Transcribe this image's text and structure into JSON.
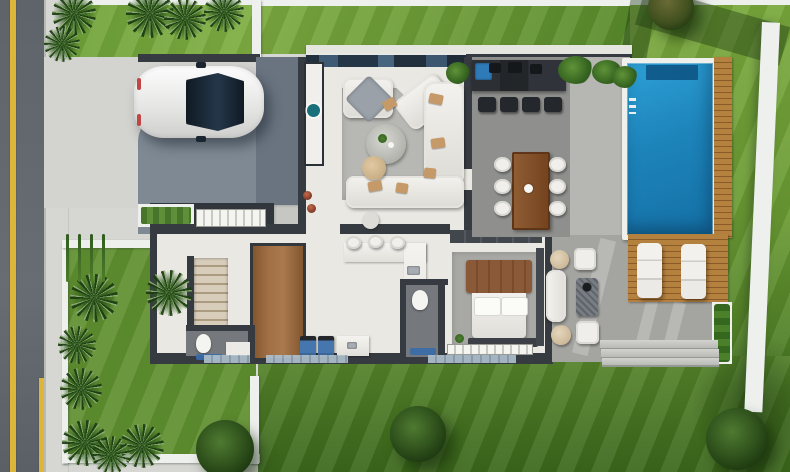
{
  "meta": {
    "title": "3D villa floor plan - top view rendering",
    "type": "architectural-rendering",
    "no_visible_text": true
  },
  "palette": {
    "road": "#5e646a",
    "yellow": "#ddb637",
    "sidewalk": "#d6d7d3",
    "whiteWall": "#eef0ee",
    "garden": "#609030",
    "drive": "#d3d3cf",
    "slab": "#6a7480",
    "slabLight": "#7e8993",
    "wall": "#363b41",
    "cream": "#eae8e2",
    "patio": "#a4a5a1",
    "patioLight": "#b6b7b3",
    "coping": "#eff0ec",
    "poolStep": "#0d5585",
    "deck": "#b5813f",
    "deckLine": "#8a5a28",
    "rug": "#b7b7b3",
    "rugBed": "#a8a8a5",
    "tan": "#c59a68",
    "teal": "#19707a",
    "blue": "#3a6ba8",
    "sinkBlue": "#2f7ab8",
    "bath": "#75787c",
    "treeLight": "#4e7a31",
    "poolWater": "#1d84ba",
    "carWhite": "#f2f2f1",
    "carGlass": "#17222e"
  },
  "scene": {
    "areas": [
      "street",
      "sidewalk",
      "driveway",
      "front-garden",
      "front-lawn",
      "back-lawn",
      "side-lawn",
      "covered-patio",
      "pool-terrace"
    ],
    "rooms": [
      "living-room",
      "kitchen",
      "hallway",
      "stairs",
      "bathroom",
      "powder-room",
      "bedroom",
      "laundry",
      "entry-porch"
    ],
    "outdoor_features": [
      "swimming-pool",
      "wood-deck",
      "sun-loungers",
      "outdoor-dining-table",
      "outdoor-bar",
      "lounge-set-with-fire-table",
      "garden-steps",
      "hedge-planter"
    ],
    "street_markings": [
      "yellow-center-line",
      "yellow-edge-line"
    ],
    "vehicle": "white-hatchback-car-on-driveway"
  },
  "sprites": [
    {
      "cls": "palm",
      "name": "palm-tree",
      "x": 52,
      "y": -8,
      "w": 44,
      "h": 44
    },
    {
      "cls": "palm",
      "name": "palm-tree",
      "x": 44,
      "y": 26,
      "w": 36,
      "h": 36
    },
    {
      "cls": "palm",
      "name": "palm-tree",
      "x": 126,
      "y": -10,
      "w": 48,
      "h": 48
    },
    {
      "cls": "palm",
      "name": "palm-tree",
      "x": 164,
      "y": -2,
      "w": 42,
      "h": 42
    },
    {
      "cls": "palm",
      "name": "palm-tree",
      "x": 204,
      "y": -8,
      "w": 40,
      "h": 40
    },
    {
      "cls": "palm",
      "name": "palm-tree",
      "x": 70,
      "y": 274,
      "w": 48,
      "h": 48
    },
    {
      "cls": "palm",
      "name": "palm-tree",
      "x": 58,
      "y": 326,
      "w": 38,
      "h": 38
    },
    {
      "cls": "palm",
      "name": "palm-tree",
      "x": 60,
      "y": 368,
      "w": 42,
      "h": 42
    },
    {
      "cls": "palm",
      "name": "palm-tree",
      "x": 62,
      "y": 420,
      "w": 46,
      "h": 46
    },
    {
      "cls": "palm",
      "name": "palm-tree",
      "x": 120,
      "y": 424,
      "w": 44,
      "h": 44
    },
    {
      "cls": "palm",
      "name": "palm-tree",
      "x": 146,
      "y": 270,
      "w": 46,
      "h": 46
    },
    {
      "cls": "palm",
      "name": "palm-tree",
      "x": 92,
      "y": 436,
      "w": 38,
      "h": 38
    },
    {
      "cls": "grass-tuft",
      "name": "tall-grass",
      "x": 66,
      "y": 234,
      "w": 3,
      "h": 48
    },
    {
      "cls": "grass-tuft",
      "name": "tall-grass",
      "x": 78,
      "y": 234,
      "w": 3,
      "h": 48
    },
    {
      "cls": "grass-tuft",
      "name": "tall-grass",
      "x": 90,
      "y": 234,
      "w": 3,
      "h": 48
    },
    {
      "cls": "grass-tuft",
      "name": "tall-grass",
      "x": 102,
      "y": 234,
      "w": 3,
      "h": 48
    },
    {
      "cls": "plant-blob",
      "name": "plant",
      "x": 558,
      "y": 56,
      "w": 36,
      "h": 28
    },
    {
      "cls": "plant-blob",
      "name": "plant",
      "x": 592,
      "y": 60,
      "w": 30,
      "h": 24
    },
    {
      "cls": "plant-blob",
      "name": "plant",
      "x": 612,
      "y": 66,
      "w": 26,
      "h": 22
    },
    {
      "cls": "plant-blob",
      "name": "plant",
      "x": 446,
      "y": 62,
      "w": 24,
      "h": 22
    },
    {
      "cls": "item-dark",
      "name": "counter-appliance",
      "x": 489,
      "y": 63,
      "w": 12,
      "h": 10
    },
    {
      "cls": "item-dark",
      "name": "counter-appliance",
      "x": 508,
      "y": 62,
      "w": 14,
      "h": 11
    },
    {
      "cls": "item-dark",
      "name": "counter-appliance",
      "x": 530,
      "y": 64,
      "w": 12,
      "h": 10
    },
    {
      "cls": "stool-dark",
      "name": "bar-stool",
      "x": 478,
      "y": 97,
      "w": 18,
      "h": 15
    },
    {
      "cls": "stool-dark",
      "name": "bar-stool",
      "x": 500,
      "y": 97,
      "w": 18,
      "h": 15
    },
    {
      "cls": "stool-dark",
      "name": "bar-stool",
      "x": 522,
      "y": 97,
      "w": 18,
      "h": 15
    },
    {
      "cls": "stool-dark",
      "name": "bar-stool",
      "x": 544,
      "y": 97,
      "w": 18,
      "h": 15
    },
    {
      "cls": "chair-white",
      "name": "dining-chair",
      "x": 494,
      "y": 157,
      "w": 17,
      "h": 15
    },
    {
      "cls": "chair-white",
      "name": "dining-chair",
      "x": 494,
      "y": 179,
      "w": 17,
      "h": 15
    },
    {
      "cls": "chair-white",
      "name": "dining-chair",
      "x": 494,
      "y": 201,
      "w": 17,
      "h": 15
    },
    {
      "cls": "chair-white",
      "name": "dining-chair",
      "x": 549,
      "y": 157,
      "w": 17,
      "h": 15
    },
    {
      "cls": "chair-white",
      "name": "dining-chair",
      "x": 549,
      "y": 179,
      "w": 17,
      "h": 15
    },
    {
      "cls": "chair-white",
      "name": "dining-chair",
      "x": 549,
      "y": 201,
      "w": 17,
      "h": 15
    },
    {
      "cls": "stool-white",
      "name": "kitchen-stool",
      "x": 346,
      "y": 236,
      "w": 15,
      "h": 13
    },
    {
      "cls": "stool-white",
      "name": "kitchen-stool",
      "x": 368,
      "y": 235,
      "w": 15,
      "h": 13
    },
    {
      "cls": "stool-white",
      "name": "kitchen-stool",
      "x": 390,
      "y": 236,
      "w": 15,
      "h": 13
    },
    {
      "cls": "washer",
      "name": "washing-machine",
      "x": 300,
      "y": 336,
      "w": 16,
      "h": 21
    },
    {
      "cls": "washer",
      "name": "dryer",
      "x": 318,
      "y": 336,
      "w": 16,
      "h": 21
    },
    {
      "cls": "cushion",
      "name": "sofa-cushion",
      "x": 429,
      "y": 94,
      "w": 14,
      "h": 10,
      "rot": 12
    },
    {
      "cls": "cushion",
      "name": "sofa-cushion",
      "x": 431,
      "y": 138,
      "w": 14,
      "h": 10,
      "rot": -8
    },
    {
      "cls": "cushion",
      "name": "sofa-cushion",
      "x": 424,
      "y": 168,
      "w": 12,
      "h": 10,
      "rot": 5
    },
    {
      "cls": "cushion",
      "name": "sofa-cushion",
      "x": 368,
      "y": 181,
      "w": 14,
      "h": 10,
      "rot": -10
    },
    {
      "cls": "cushion",
      "name": "sofa-cushion",
      "x": 396,
      "y": 183,
      "w": 12,
      "h": 10,
      "rot": 8
    },
    {
      "cls": "cushion",
      "name": "sofa-cushion",
      "x": 383,
      "y": 99,
      "w": 13,
      "h": 10,
      "rot": -30
    },
    {
      "cls": "pouf-round",
      "name": "ottoman",
      "x": 550,
      "y": 250,
      "w": 19,
      "h": 19
    },
    {
      "cls": "pouf-round",
      "name": "ottoman",
      "x": 551,
      "y": 325,
      "w": 20,
      "h": 20
    },
    {
      "cls": "pouf-square",
      "name": "pouf",
      "x": 574,
      "y": 248,
      "w": 22,
      "h": 22
    },
    {
      "cls": "pouf-square",
      "name": "pouf",
      "x": 576,
      "y": 321,
      "w": 23,
      "h": 23
    },
    {
      "cls": "bench-white",
      "name": "lounge-bench",
      "x": 546,
      "y": 270,
      "w": 20,
      "h": 52
    },
    {
      "cls": "firetable",
      "name": "fire-table",
      "x": 576,
      "y": 278,
      "w": 22,
      "h": 38
    },
    {
      "cls": "lounger",
      "name": "sun-lounger",
      "x": 637,
      "y": 243,
      "w": 25,
      "h": 55
    },
    {
      "cls": "lounger",
      "name": "sun-lounger",
      "x": 681,
      "y": 244,
      "w": 25,
      "h": 55
    },
    {
      "cls": "step-band",
      "name": "garden-step",
      "x": 600,
      "y": 340,
      "w": 118,
      "h": 8
    },
    {
      "cls": "step-band",
      "name": "garden-step",
      "x": 601,
      "y": 349,
      "w": 118,
      "h": 8
    },
    {
      "cls": "step-band",
      "name": "garden-step",
      "x": 602,
      "y": 358,
      "w": 117,
      "h": 7
    },
    {
      "cls": "glass-panel",
      "name": "window-band",
      "x": 204,
      "y": 355,
      "w": 46,
      "h": 8
    },
    {
      "cls": "glass-panel",
      "name": "window-band",
      "x": 266,
      "y": 355,
      "w": 82,
      "h": 8
    },
    {
      "cls": "glass-panel",
      "name": "window-band",
      "x": 428,
      "y": 355,
      "w": 88,
      "h": 8
    },
    {
      "cls": "white-ticks",
      "name": "entry-glazing",
      "x": 196,
      "y": 209,
      "w": 70,
      "h": 18
    },
    {
      "cls": "white-ticks",
      "name": "bedroom-window",
      "x": 447,
      "y": 344,
      "w": 86,
      "h": 11
    },
    {
      "cls": "pot",
      "name": "flower-pot",
      "x": 303,
      "y": 191,
      "w": 9,
      "h": 9
    },
    {
      "cls": "pot",
      "name": "flower-pot",
      "x": 307,
      "y": 204,
      "w": 9,
      "h": 9
    },
    {
      "cls": "tree",
      "name": "round-tree",
      "x": 196,
      "y": 420,
      "w": 58,
      "h": 58
    },
    {
      "cls": "tree",
      "name": "round-tree",
      "x": 390,
      "y": 406,
      "w": 56,
      "h": 56
    },
    {
      "cls": "tree",
      "name": "round-tree",
      "x": 706,
      "y": 408,
      "w": 62,
      "h": 62
    },
    {
      "cls": "tree tree-dry",
      "name": "round-tree",
      "x": 648,
      "y": -16,
      "w": 46,
      "h": 46
    }
  ]
}
